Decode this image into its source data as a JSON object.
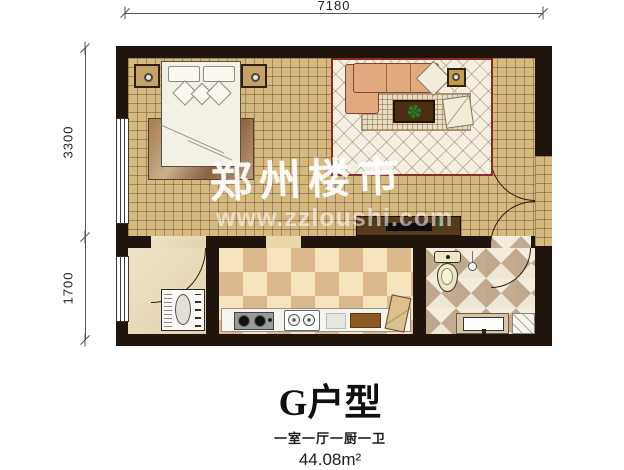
{
  "annotations": {
    "dim_top": "7180",
    "dim_left_upper": "3300",
    "dim_left_lower": "1700"
  },
  "watermark": {
    "brand": "郑州楼市",
    "url": "www.zzloushi.com"
  },
  "caption": {
    "title": "G户型",
    "layout": "一室一厅一厨一卫",
    "area": "44.08m²"
  },
  "colors": {
    "wall": "#20150c",
    "floor_tile": "#d6b97e",
    "rug_border": "#8e2b20",
    "sofa": "#e2a87e",
    "kitchen_checker_dark": "#dcb98c",
    "kitchen_checker_light": "#f6e4bd",
    "bath_tile": "#c2ab8e"
  },
  "icons": [
    "window-icon",
    "double-door-icon",
    "door-arc-icon",
    "bed-icon",
    "pillow-icon",
    "nightstand-icon",
    "rug-icon",
    "sofa-icon",
    "armchair-icon",
    "end-table-icon",
    "coffee-table-icon",
    "plant-icon",
    "tv-cabinet-icon",
    "washing-machine-icon",
    "stove-icon",
    "kitchen-sink-icon",
    "cutting-board-icon",
    "toilet-icon",
    "shower-head-icon",
    "vanity-sink-icon",
    "bath-mat-icon"
  ]
}
